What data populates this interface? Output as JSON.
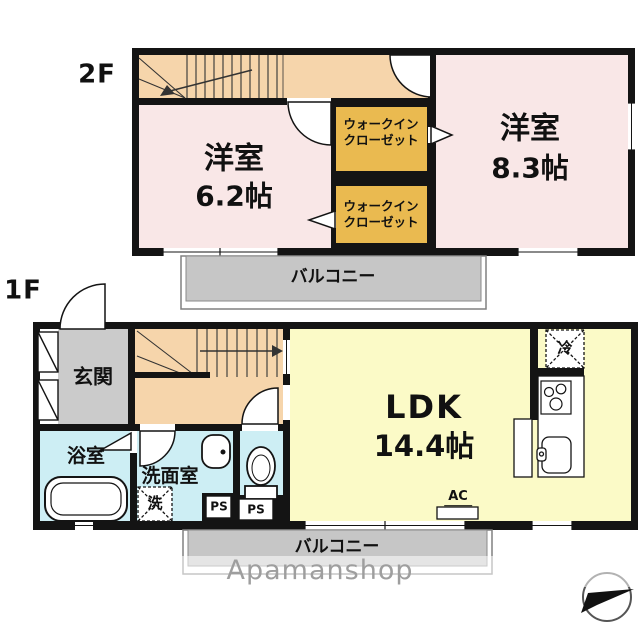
{
  "floor2": {
    "label": "2F",
    "room62": {
      "name": "洋室",
      "area": "6.2帖"
    },
    "room83": {
      "name": "洋室",
      "area": "8.3帖"
    },
    "wic1": {
      "line1": "ウォークイン",
      "line2": "クローゼット"
    },
    "wic2": {
      "line1": "ウォークイン",
      "line2": "クローゼット"
    },
    "balcony": "バルコニー"
  },
  "floor1": {
    "label": "1F",
    "entrance": "玄関",
    "bathroom": "浴室",
    "washroom": "洗面室",
    "washer": "洗",
    "fridge": "冷",
    "ldk": {
      "name": "LDK",
      "area": "14.4帖"
    },
    "ps1": "PS",
    "ps2": "PS",
    "ac": "AC",
    "balcony": "バルコニー"
  },
  "watermark": "Apamanshop",
  "icons": {
    "north_arrow": "north-arrow-compass",
    "fridge_box": "refrigerator-placeholder",
    "washer_box": "washing-machine-placeholder"
  },
  "colors": {
    "wall": "#141414",
    "room_pink": "#f9e7e7",
    "corridor_orange": "#f6d5ab",
    "closet_gold": "#eaba50",
    "ldk_yellow": "#fbfac7",
    "wet_blue": "#cdeef4",
    "entrance_gray": "#cbcbcb",
    "balcony_gray": "#c6c6c6",
    "watermark_gray": "#9e9e9e"
  }
}
